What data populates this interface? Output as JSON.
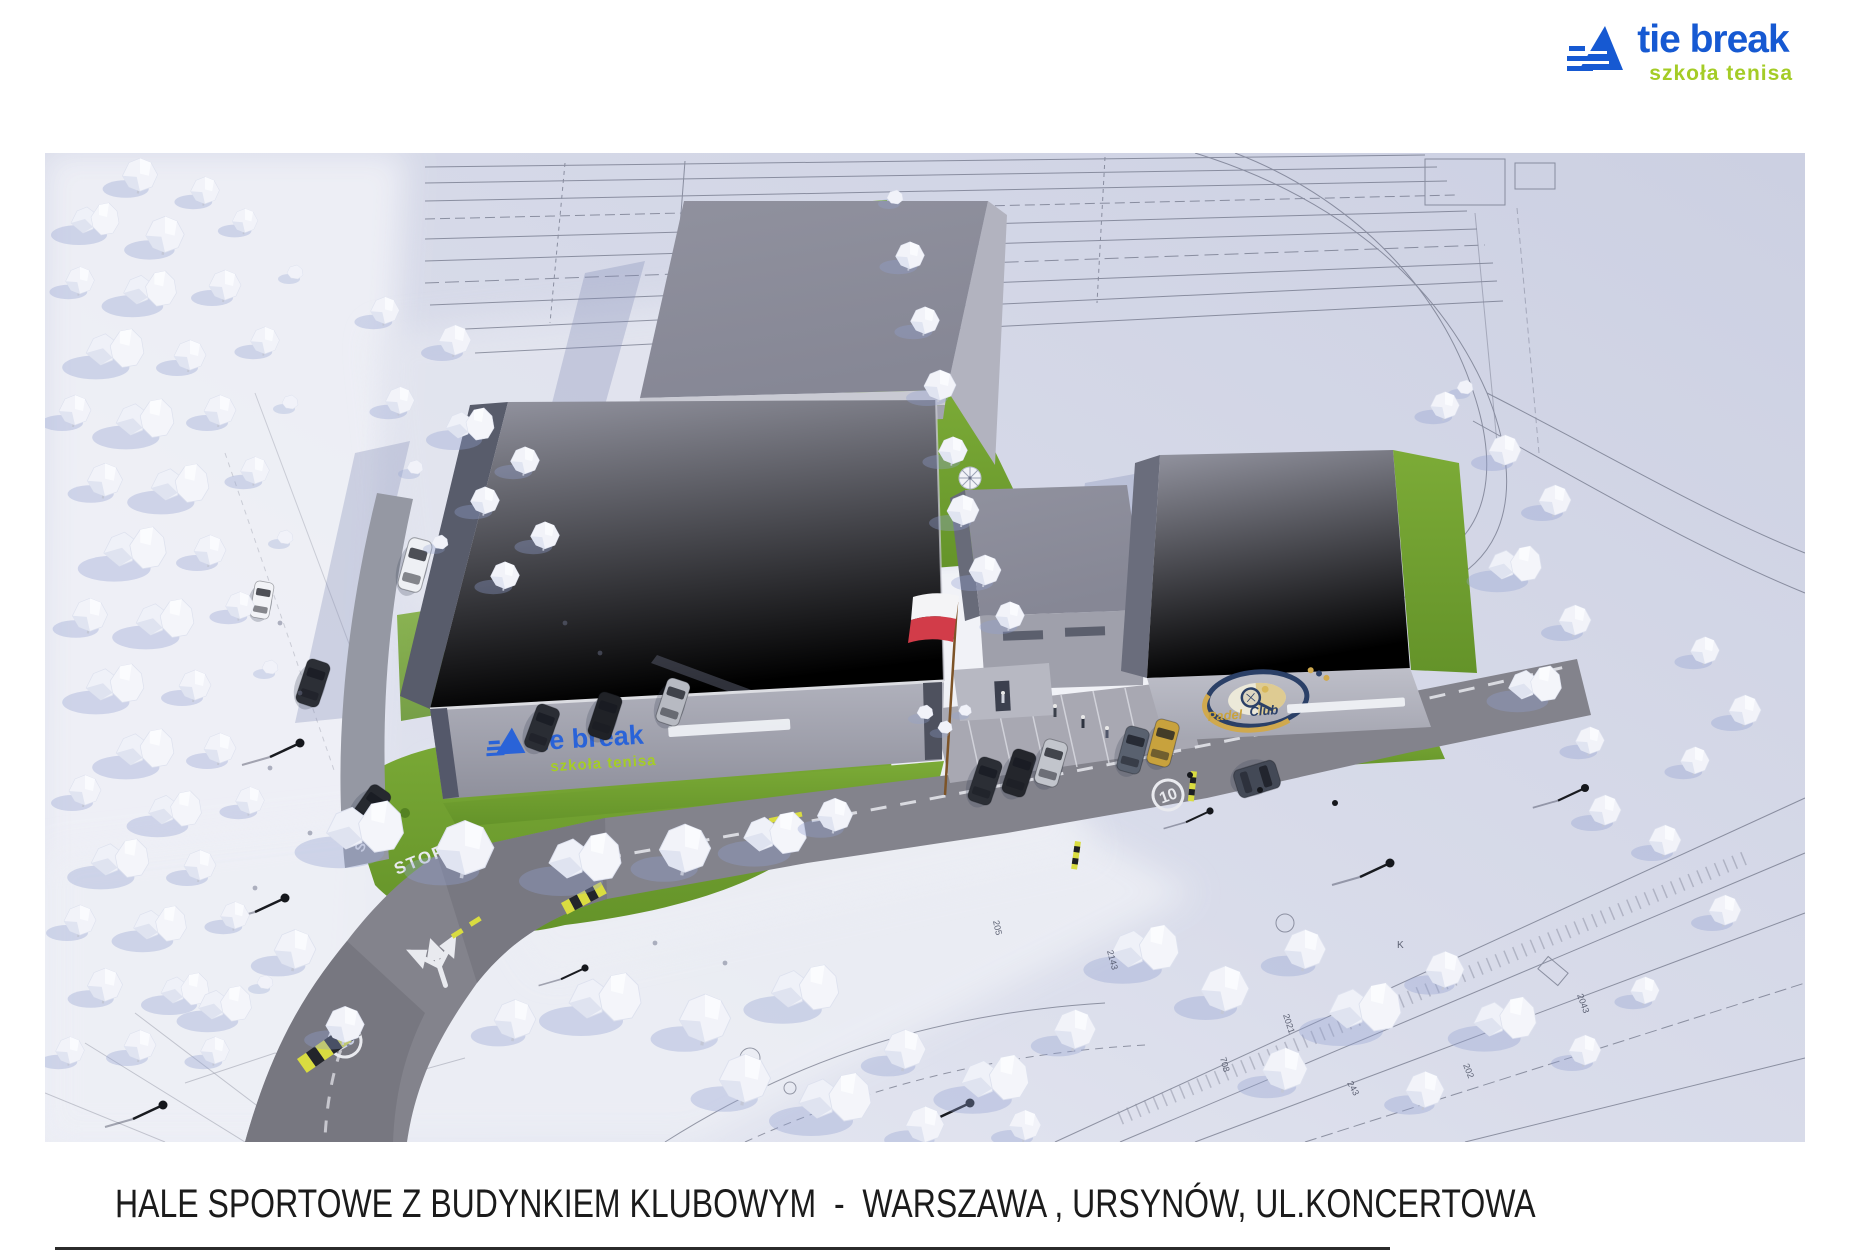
{
  "brand": {
    "name": "tie break",
    "tagline": "szkoła tenisa"
  },
  "caption": {
    "title": "HALE SPORTOWE Z BUDYNKIEM KLUBOWYM  -  WARSZAWA , URSYNÓW, UL.KONCERTOWA"
  },
  "render": {
    "padel_logo": {
      "word1": "Padel",
      "word2": "Club"
    },
    "road_markings": {
      "stop": "STOP",
      "speed_limit": "10"
    },
    "blueprint_annotations": [
      "2143",
      "205",
      "2021",
      "708",
      "243",
      "202",
      "2043",
      "K"
    ],
    "colors": {
      "brand_blue": "#1659d2",
      "brand_green": "#a4cc26",
      "grass_green": "#6f9e2d",
      "roof_gray": "#8b8c99",
      "road_gray": "#84848d",
      "background_lavender": "#d6d9e8",
      "flag_red": "#d23c49",
      "emblem_navy": "#2b4067",
      "emblem_gold": "#d0a94e"
    }
  }
}
